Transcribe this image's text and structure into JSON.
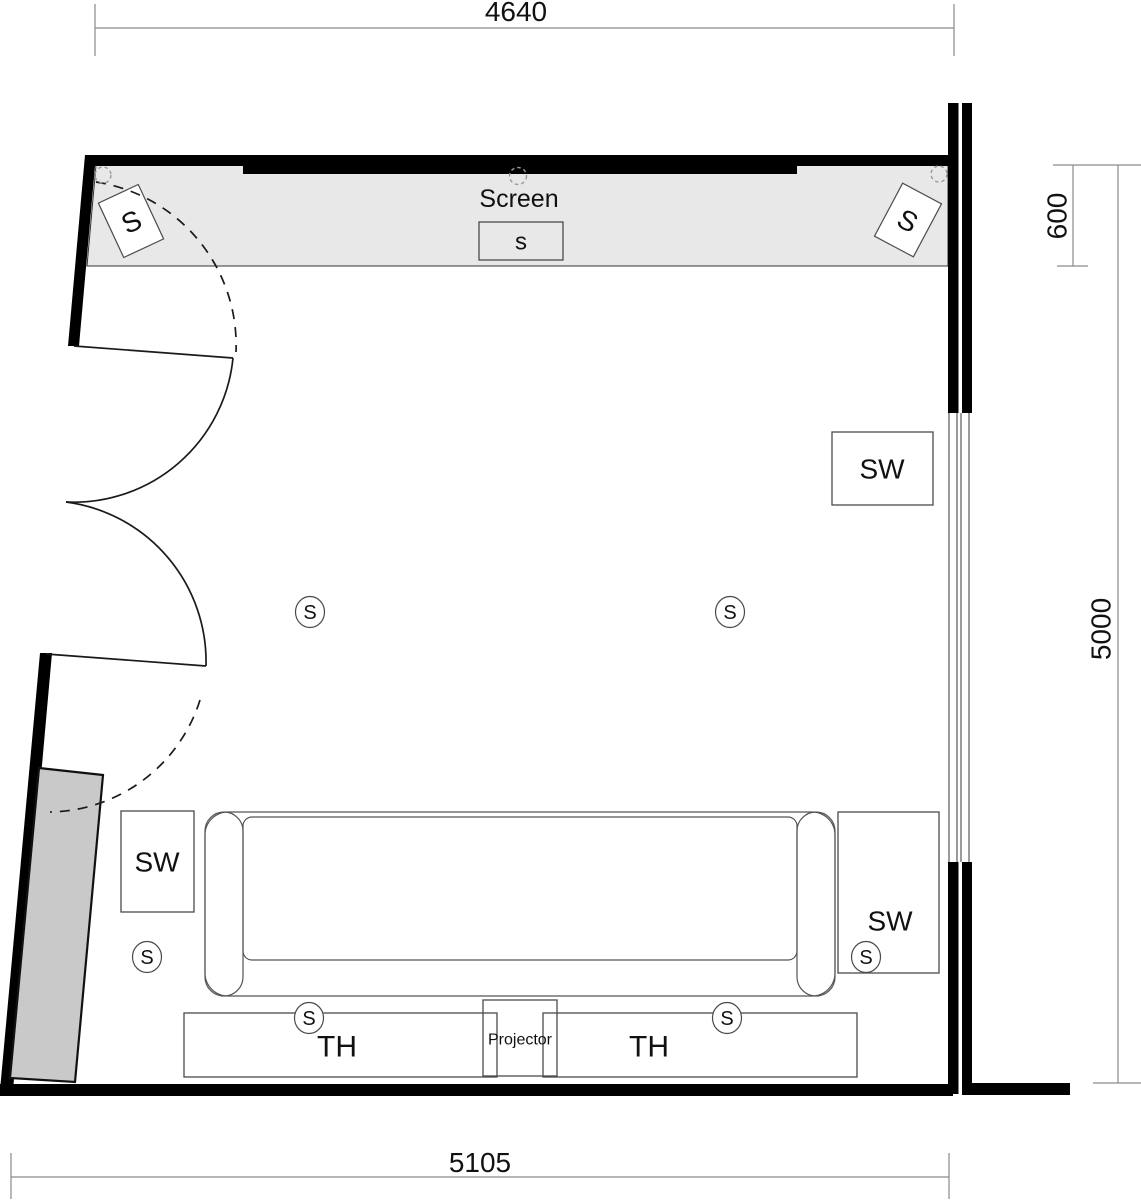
{
  "dimensions": {
    "width_top": "4640",
    "width_bottom": "5105",
    "screen_wall_depth": "600",
    "room_depth": "5000"
  },
  "screen": {
    "label": "Screen",
    "center_speaker_label": "s"
  },
  "front_speakers": {
    "left_label": "S",
    "right_label": "S"
  },
  "speaker_circles": [
    {
      "id": "side-left",
      "label": "S"
    },
    {
      "id": "side-right",
      "label": "S"
    },
    {
      "id": "surround-left",
      "label": "S"
    },
    {
      "id": "surround-right",
      "label": "S"
    },
    {
      "id": "rear-left",
      "label": "S"
    },
    {
      "id": "rear-right",
      "label": "S"
    }
  ],
  "subwoofers": [
    {
      "id": "sw-right-wall",
      "label": "SW"
    },
    {
      "id": "sw-rear-left",
      "label": "SW"
    },
    {
      "id": "sw-rear-right",
      "label": "SW"
    }
  ],
  "equipment": {
    "projector_label": "Projector",
    "th_left_label": "TH",
    "th_right_label": "TH"
  },
  "colors": {
    "wall": "#000000",
    "screen_zone_fill": "#e8e8e8",
    "screen_bar": "#000000",
    "cabinet_fill": "#c9c9c9",
    "dimension_line": "#8a8a8a",
    "outline": "#4a4a4a",
    "text": "#111111"
  }
}
